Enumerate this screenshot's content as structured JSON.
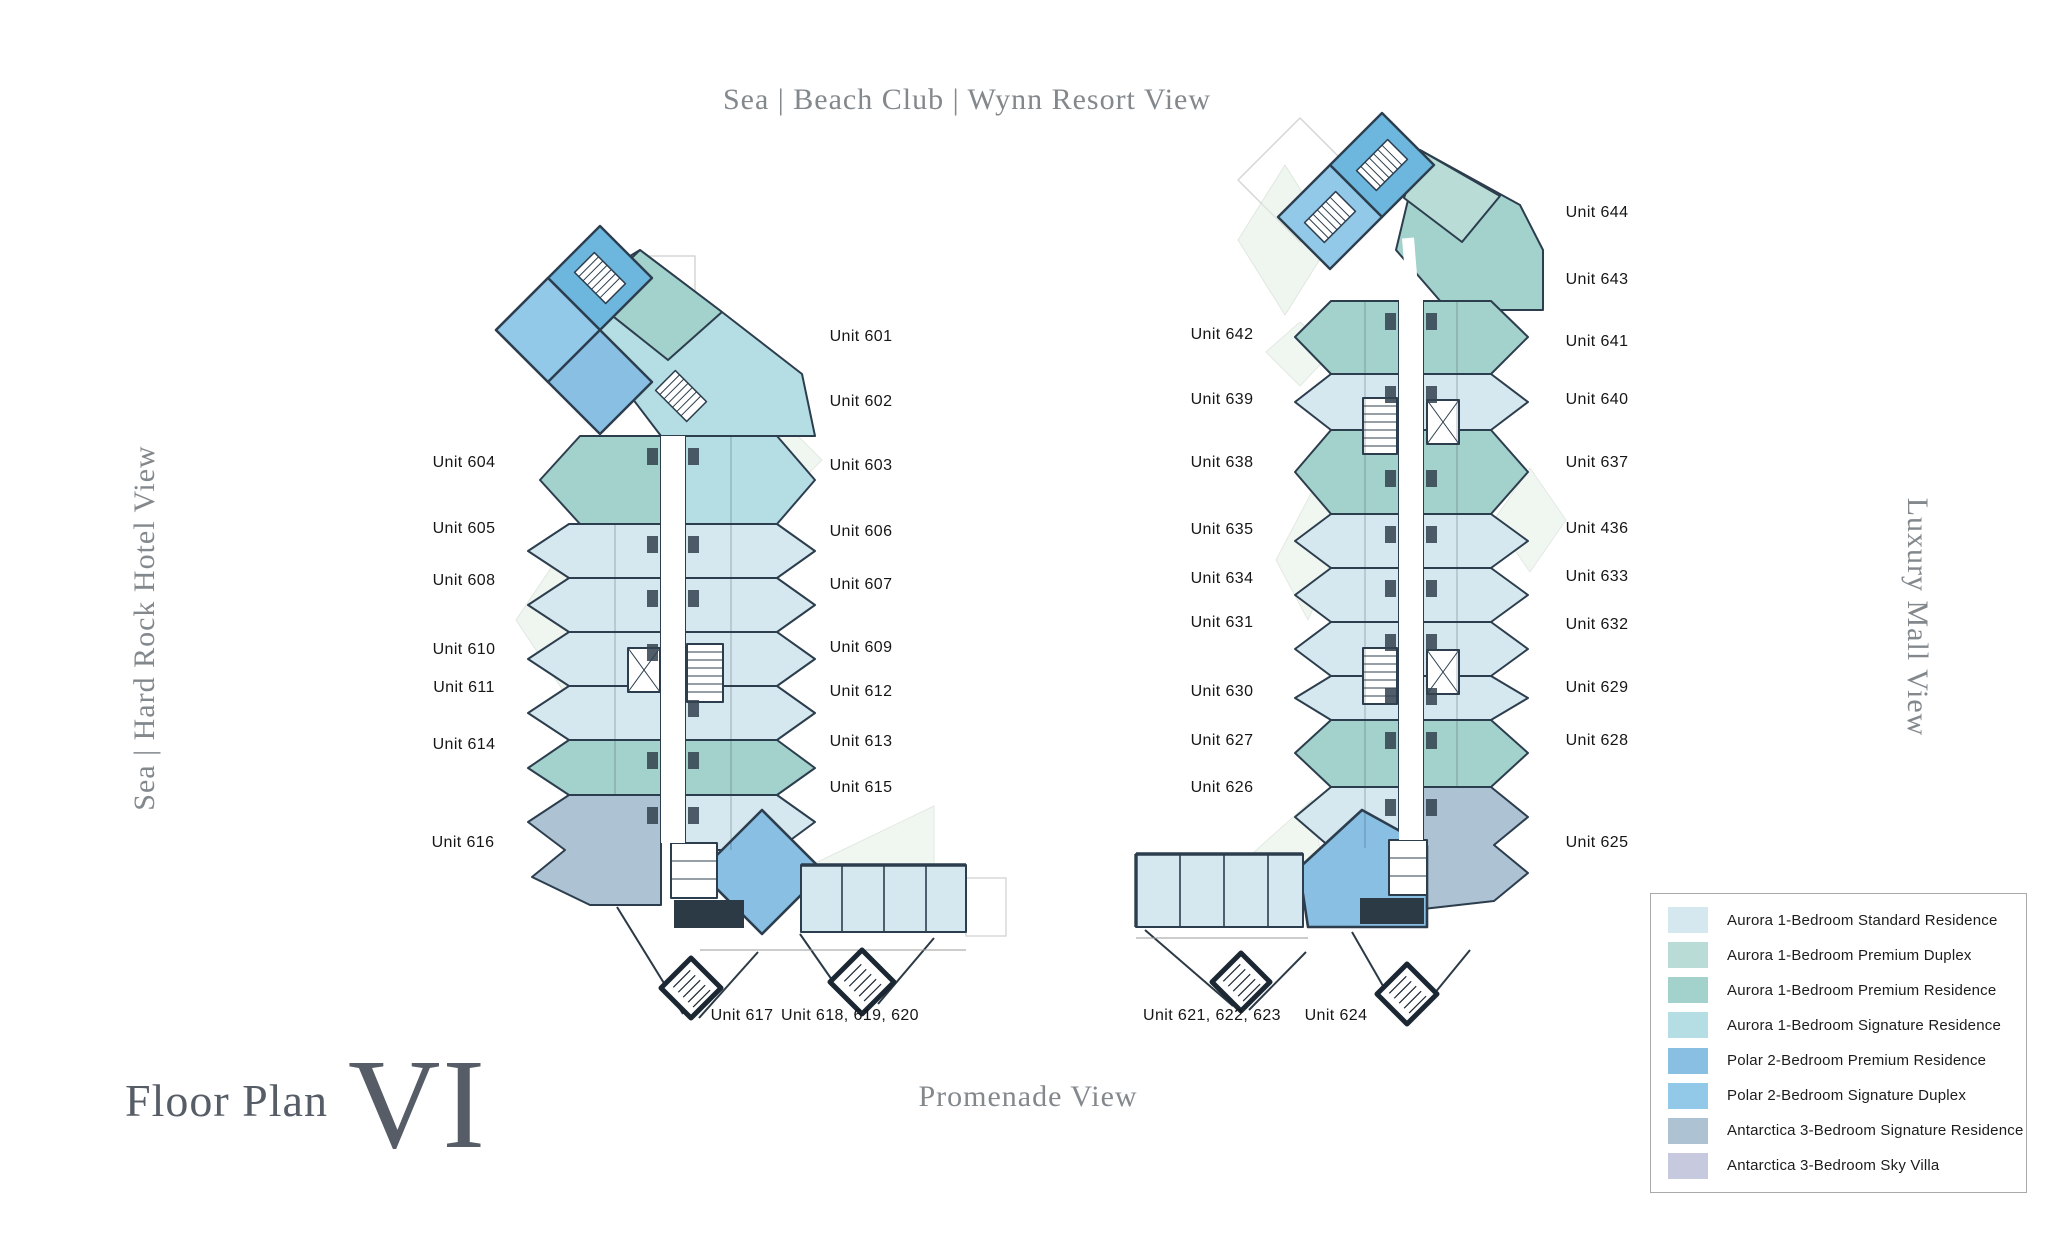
{
  "titles": {
    "top": "Sea | Beach Club | Wynn Resort View",
    "left": "Sea | Hard Rock Hotel View",
    "right": "Luxury Mall View",
    "bottom": "Promenade View"
  },
  "floor_plan": {
    "label": "Floor Plan",
    "numeral": "VI"
  },
  "unit_labels": [
    "Unit 604",
    "Unit 605",
    "Unit 608",
    "Unit 610",
    "Unit 611",
    "Unit 614",
    "Unit 616",
    "Unit 601",
    "Unit 602",
    "Unit 603",
    "Unit 606",
    "Unit 607",
    "Unit 609",
    "Unit 612",
    "Unit 613",
    "Unit 615",
    "Unit 617",
    "Unit 618, 619, 620",
    "Unit 642",
    "Unit 639",
    "Unit 638",
    "Unit 635",
    "Unit 634",
    "Unit 631",
    "Unit 630",
    "Unit 627",
    "Unit 626",
    "Unit 644",
    "Unit 643",
    "Unit 641",
    "Unit 640",
    "Unit 637",
    "Unit 436",
    "Unit 633",
    "Unit 632",
    "Unit 629",
    "Unit 628",
    "Unit 625",
    "Unit 621, 622, 623",
    "Unit 624"
  ],
  "legend": {
    "items": [
      {
        "label": "Aurora 1-Bedroom Standard Residence",
        "color": "#d5e8ef"
      },
      {
        "label": "Aurora 1-Bedroom Premium Duplex",
        "color": "#b9dcd7"
      },
      {
        "label": "Aurora 1-Bedroom Premium Residence",
        "color": "#a3d1cc"
      },
      {
        "label": "Aurora 1-Bedroom Signature Residence",
        "color": "#b5dde4"
      },
      {
        "label": "Polar 2-Bedroom Premium Residence",
        "color": "#89bfe3"
      },
      {
        "label": "Polar 2-Bedroom Signature Duplex",
        "color": "#92c9e9"
      },
      {
        "label": "Antarctica 3-Bedroom Signature Residence",
        "color": "#adc3d3"
      },
      {
        "label": "Antarctica 3-Bedroom Sky Villa",
        "color": "#c7cade"
      }
    ]
  },
  "palette": {
    "aurora_standard": "#d5e8ef",
    "aurora_premium_duplex": "#b9dcd7",
    "aurora_premium_residence": "#a3d1cc",
    "aurora_signature": "#b5dde4",
    "polar_premium": "#89bfe3",
    "polar_signature_duplex": "#92c9e9",
    "antarctica_signature": "#adc3d3",
    "antarctica_sky_villa": "#c7cade",
    "head_accent": "#6db6dd",
    "sage": "#e3eee3",
    "line": "#2c3e4e"
  }
}
